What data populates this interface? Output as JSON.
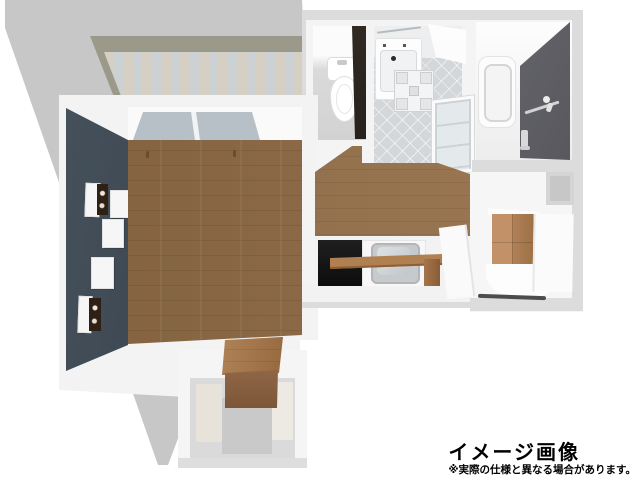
{
  "render": {
    "type": "3d-birdseye-floorplan",
    "rooms": [
      "balcony",
      "living-room",
      "toilet-room",
      "washroom",
      "bathroom",
      "hallway-kitchen",
      "closet",
      "entrance-porch"
    ]
  },
  "caption": {
    "title": "イメージ画像",
    "disclaimer": "※実際の仕様と異なる場合があります。",
    "text_color": "#000000"
  },
  "palette": {
    "background": "#ffffff",
    "shadow": "#c7c7c7",
    "outer_wall": "#dcdcdc",
    "wall_white": "#f4f4f4",
    "accent_wall": "#39434e",
    "wood_floor": "#8a6747",
    "balcony_wall": "#9b998a",
    "balcony_deck": "#d3cfc6",
    "window_glass": "#b7c0c7",
    "kitchen_panel": "#161616",
    "sink_gray": "#c6cacd",
    "counter_wood": "#b08050",
    "closet_wood": "#b98a5e",
    "bath_dark_wall": "#55555b",
    "toilet_floor": "#d2d2d2",
    "washroom_floor": "#d3d7da",
    "entrance_floor": "#c9c9c9",
    "entrance_wall": "#e7e3da",
    "door_dark": "#1d1814",
    "threshold": "#4c4c4c",
    "window_square": "#c7c7c7"
  }
}
